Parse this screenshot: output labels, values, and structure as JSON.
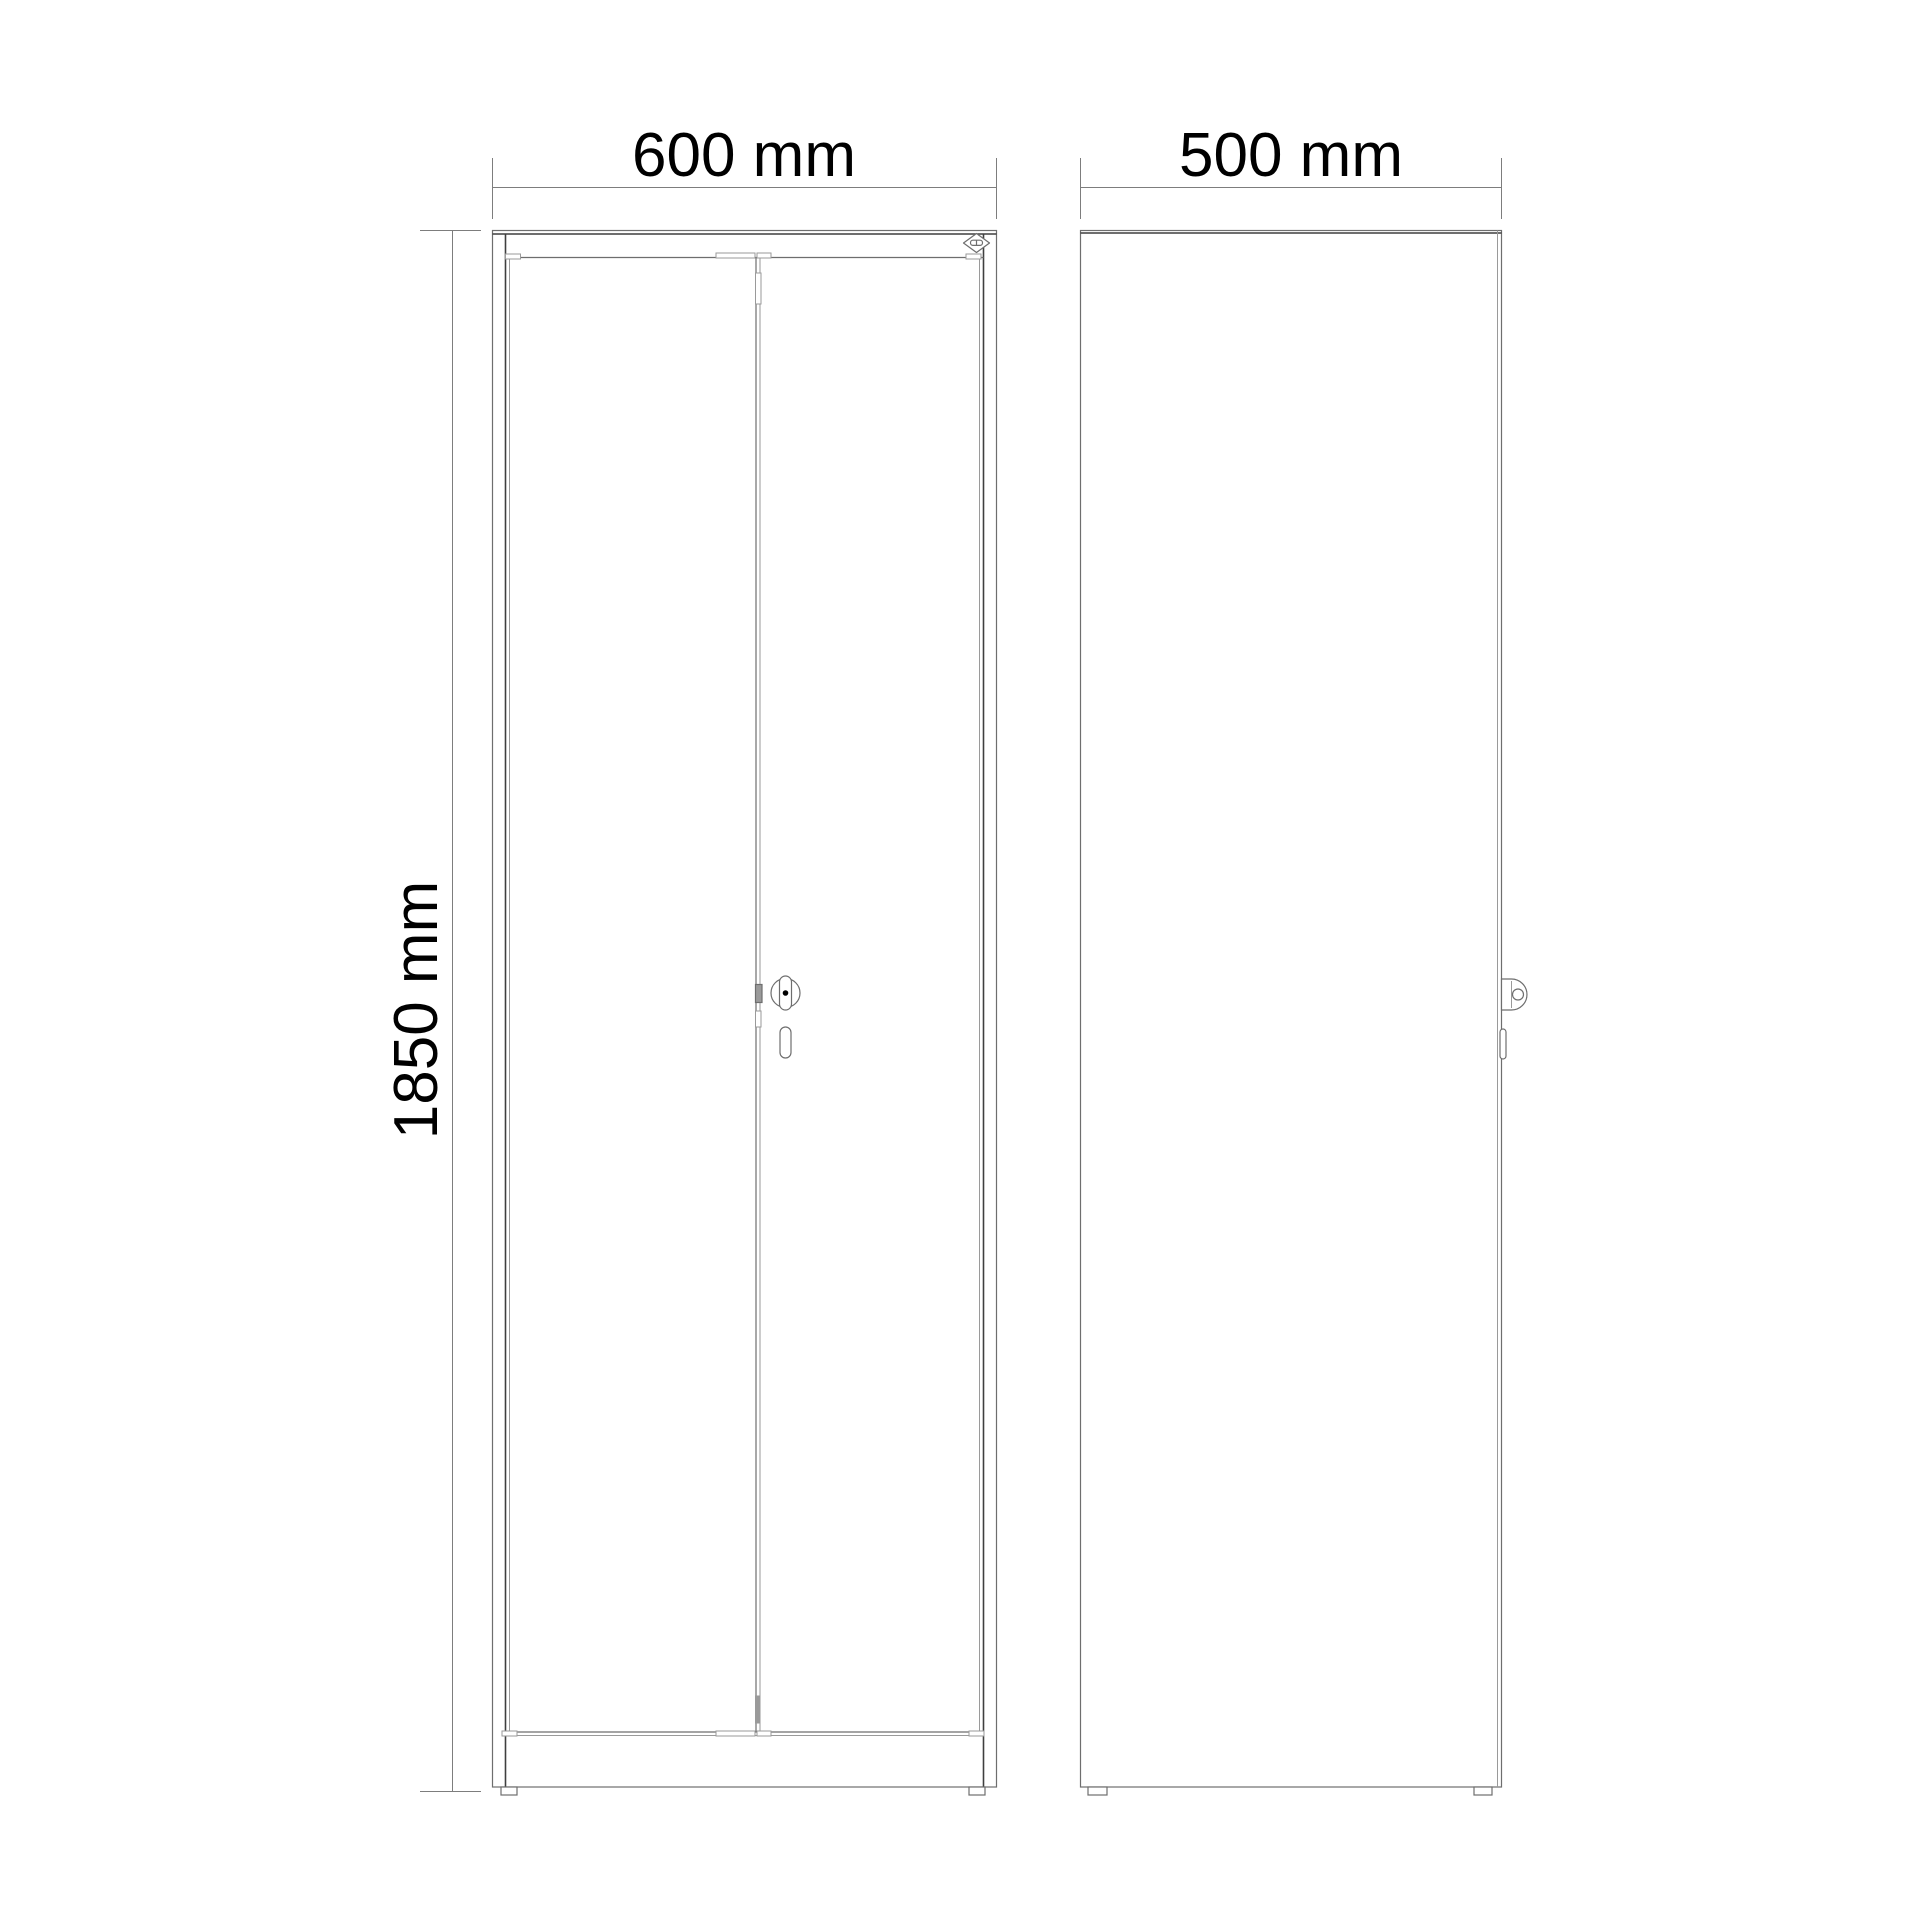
{
  "drawing": {
    "front_view": {
      "width_label": "600 mm",
      "height_label": "1850 mm"
    },
    "side_view": {
      "depth_label": "500 mm"
    },
    "icons": {
      "brand_logo": "diamond-emblem",
      "lock_front": "cylinder-cam-lock",
      "lock_side": "cylinder-cam-lock-profile",
      "keyhole": "key-slot"
    }
  },
  "colors": {
    "background": "#ffffff",
    "dark": "#3f3f3f",
    "mid": "#6e6e6e",
    "light": "#9a9a9a",
    "dimension": "#7d7d7d",
    "text": "#000000"
  }
}
